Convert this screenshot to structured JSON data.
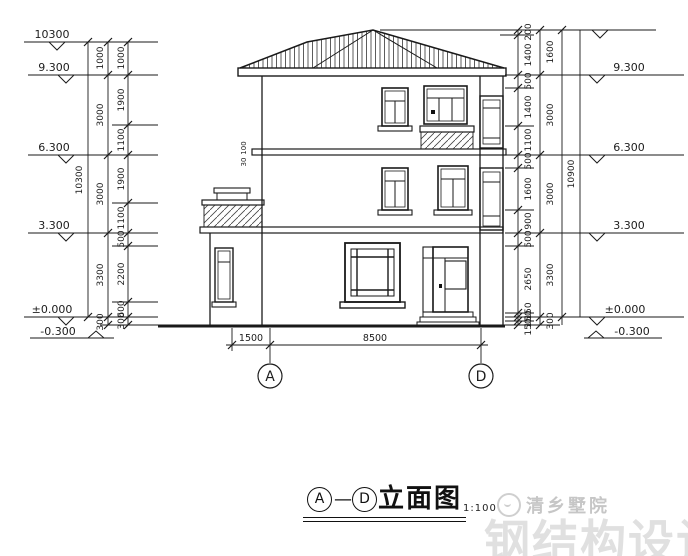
{
  "levels": {
    "left": [
      "10300",
      "9.300",
      "6.300",
      "3.300",
      "±0.000",
      "-0.300"
    ],
    "right": [
      "9.300",
      "6.300",
      "3.300",
      "±0.000",
      "-0.300"
    ]
  },
  "dims": {
    "left_total": "10300",
    "left_story": [
      "1000",
      "3000",
      "3000",
      "3300",
      "300"
    ],
    "left_detail": [
      "1000",
      "1900",
      "1100",
      "1900",
      "1100",
      "500",
      "2200",
      "600",
      "300"
    ],
    "right_total": "10900",
    "right_story": [
      "1600",
      "3000",
      "3000",
      "3300",
      "300"
    ],
    "right_detail": [
      "200",
      "1400",
      "500",
      "1400",
      "1100",
      "500",
      "1600",
      "900",
      "500",
      "2650",
      "150",
      "150",
      "150"
    ],
    "bottom": [
      "1500",
      "8500"
    ],
    "slab_detail": [
      "100",
      "30"
    ]
  },
  "grid": {
    "a": "A",
    "d": "D"
  },
  "title": {
    "start": "A",
    "separator": "—",
    "end": "D",
    "text": "立面图",
    "scale": "1:100"
  },
  "watermark": {
    "brand": "清乡墅院",
    "background": "钢结构设计"
  },
  "colors": {
    "line": "#1a1a1a",
    "watermark_brand": "#c6c6c6",
    "watermark_big": "#e0e0e0"
  }
}
